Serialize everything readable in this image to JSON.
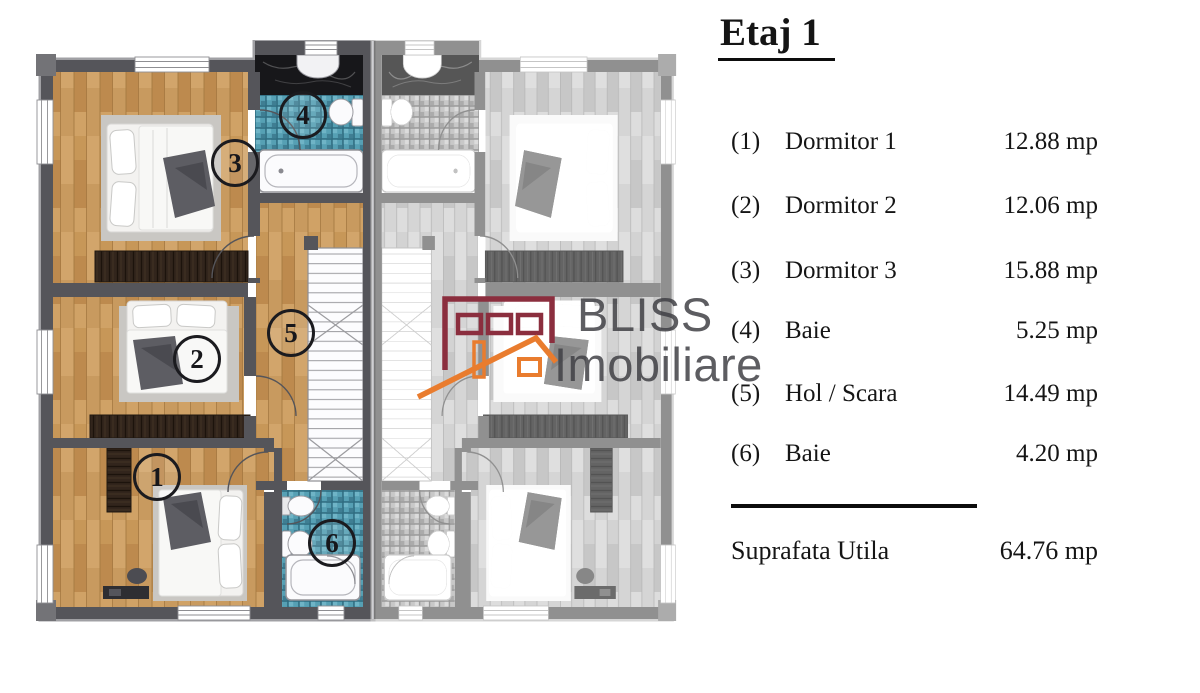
{
  "legend": {
    "title": "Etaj 1",
    "rows": [
      {
        "num": "(1)",
        "name": "Dormitor 1",
        "area": "12.88 mp"
      },
      {
        "num": "(2)",
        "name": "Dormitor 2",
        "area": "12.06 mp"
      },
      {
        "num": "(3)",
        "name": "Dormitor 3",
        "area": "15.88 mp"
      },
      {
        "num": "(4)",
        "name": "Baie",
        "area": "5.25 mp"
      },
      {
        "num": "(5)",
        "name": "Hol / Scara",
        "area": "14.49 mp"
      },
      {
        "num": "(6)",
        "name": "Baie",
        "area": "4.20 mp"
      }
    ],
    "total_label": "Suprafata Utila",
    "total_area": "64.76 mp"
  },
  "plan": {
    "room_numbers": [
      "1",
      "2",
      "3",
      "4",
      "5",
      "6"
    ]
  },
  "watermark": {
    "line1": "BLISS",
    "line2": "Imobiliare"
  },
  "colors": {
    "brand_maroon": "#8b2e3e",
    "brand_orange": "#e97c2e",
    "wood_floor": "#c79758",
    "bathroom_tile": "#56a0b4",
    "wall_gray": "#55555a",
    "text": "#151515"
  }
}
